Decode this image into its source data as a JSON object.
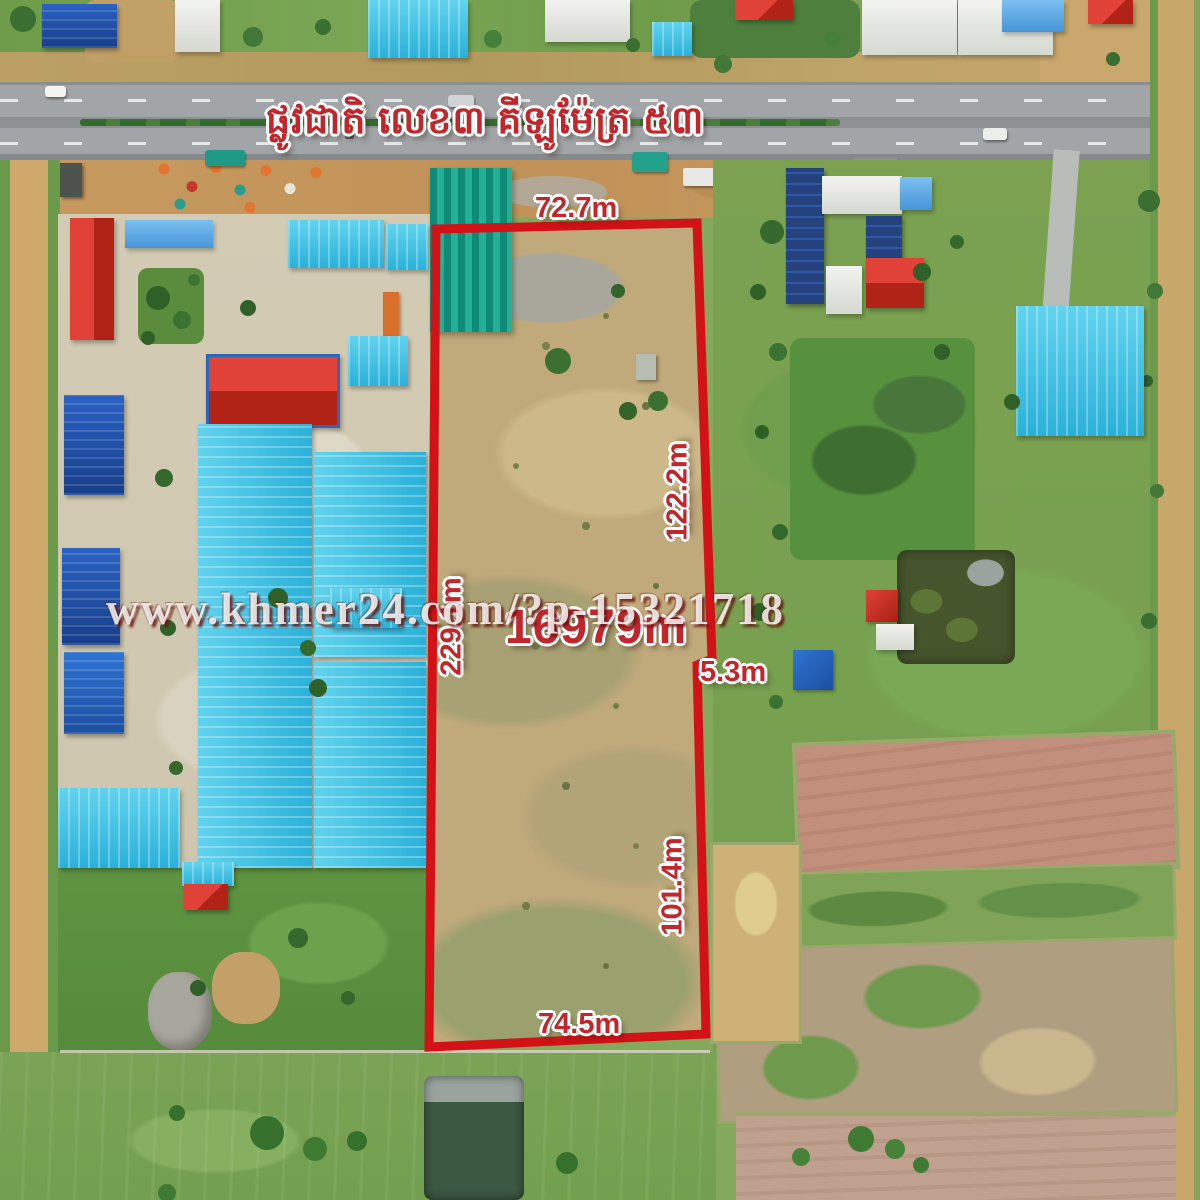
{
  "overlay": {
    "road_name_khmer": "ផ្លូវជាតិ លេខ៣ គីឡូម៉ែត្រ ៥៣",
    "area_label": "16979m",
    "measurements": {
      "top": "72.7m",
      "left": "229.1m",
      "right_upper": "122.2m",
      "right_step": "5.3m",
      "right_lower": "101.4m",
      "bottom": "74.5m"
    },
    "boundary_color": "#d21217",
    "label_color": "#bf272c"
  },
  "watermark": {
    "text": "www.khmer24.com/?p-15321718"
  }
}
